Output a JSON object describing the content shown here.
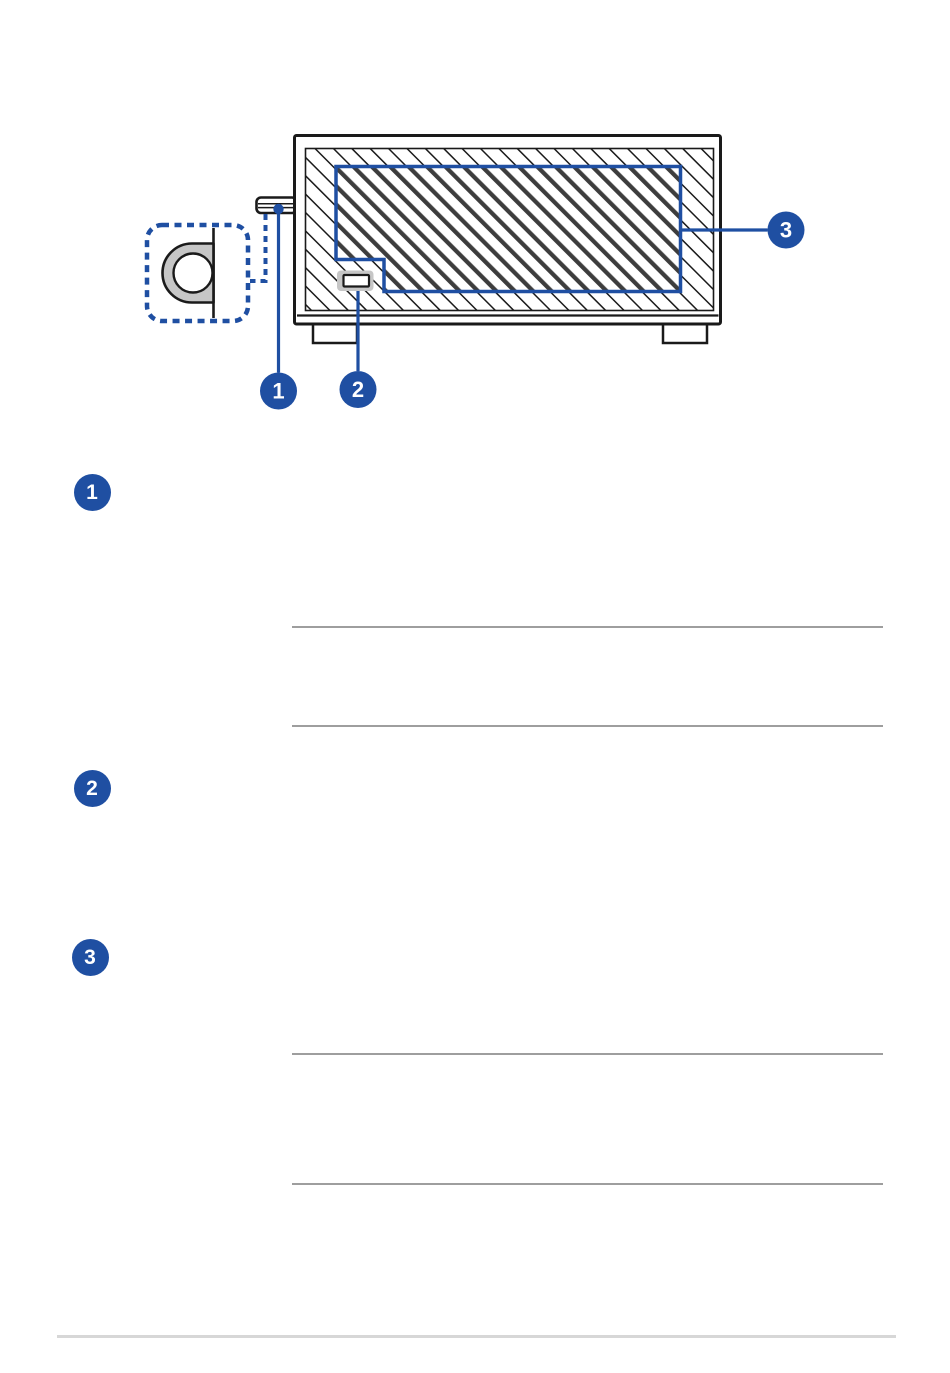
{
  "page": {
    "background": "#ffffff"
  },
  "colors": {
    "accent_blue": "#1F4FA2",
    "line_black": "#1a1a1a",
    "fill_gray": "#c6c6c6",
    "vent_dark_stripe": "#3d3d3d",
    "section_rule_gray": "#9e9e9e",
    "footer_rule_gray": "#d7d7d7"
  },
  "diagram": {
    "callouts": [
      {
        "label": "1"
      },
      {
        "label": "2"
      },
      {
        "label": "3"
      }
    ]
  },
  "sections": [
    {
      "marker": "1"
    },
    {
      "marker": "2"
    },
    {
      "marker": "3"
    }
  ]
}
